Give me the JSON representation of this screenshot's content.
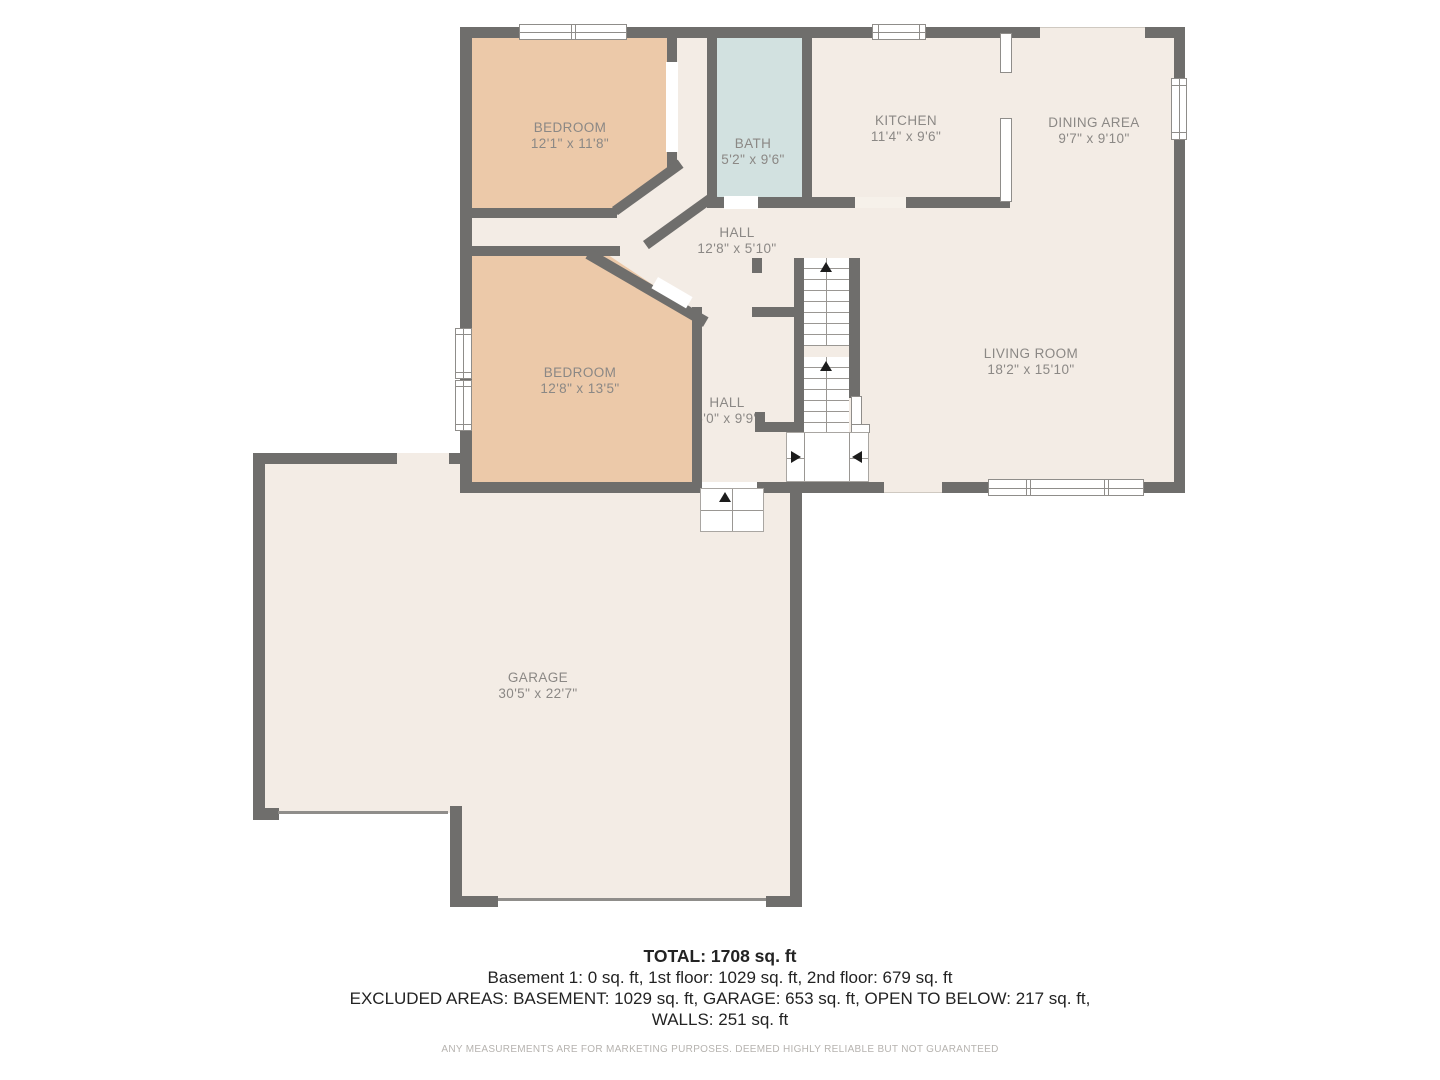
{
  "rooms": [
    {
      "id": "bedroom-1",
      "name": "BEDROOM",
      "dims": "12'1\" x 11'8\""
    },
    {
      "id": "bath",
      "name": "BATH",
      "dims": "5'2\" x 9'6\""
    },
    {
      "id": "kitchen",
      "name": "KITCHEN",
      "dims": "11'4\" x 9'6\""
    },
    {
      "id": "dining-area",
      "name": "DINING AREA",
      "dims": "9'7\" x 9'10\""
    },
    {
      "id": "hall-upper",
      "name": "HALL",
      "dims": "12'8\" x 5'10\""
    },
    {
      "id": "bedroom-2",
      "name": "BEDROOM",
      "dims": "12'8\" x 13'5\""
    },
    {
      "id": "hall-lower",
      "name": "HALL",
      "dims": "5'0\" x 9'9\""
    },
    {
      "id": "living-room",
      "name": "LIVING ROOM",
      "dims": "18'2\" x 15'10\""
    },
    {
      "id": "garage",
      "name": "GARAGE",
      "dims": "30'5\" x 22'7\""
    }
  ],
  "summary": {
    "total": "TOTAL: 1708 sq. ft",
    "floors": "Basement 1: 0 sq. ft, 1st floor: 1029 sq. ft, 2nd floor: 679 sq. ft",
    "excluded": "EXCLUDED AREAS: BASEMENT: 1029 sq. ft, GARAGE: 653 sq. ft, OPEN TO BELOW: 217 sq. ft,",
    "walls": "WALLS: 251 sq. ft",
    "disclaimer": "ANY MEASUREMENTS ARE FOR MARKETING PURPOSES. DEEMED HIGHLY RELIABLE BUT NOT GUARANTEED"
  },
  "colors": {
    "wall": "#6f6e6c",
    "floor": "#f3ece5",
    "bedroom_fill": "#ecc9a9",
    "bath_fill": "#d2e1e0",
    "label_text": "#8b8885"
  }
}
